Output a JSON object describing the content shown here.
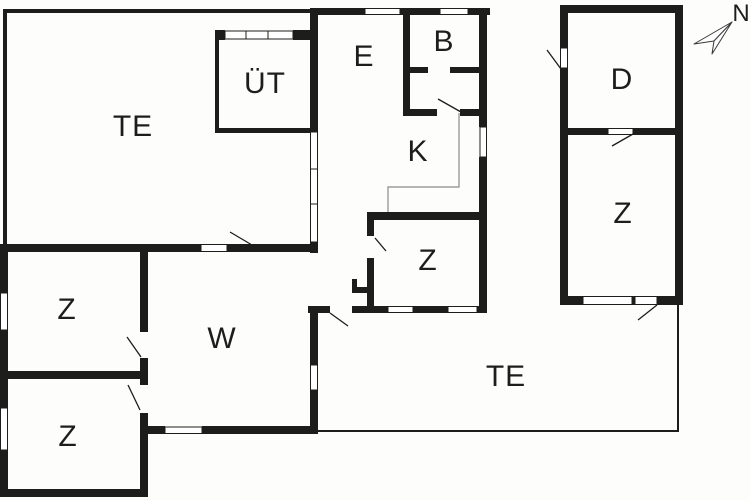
{
  "plan": {
    "title": "floor-plan",
    "compass": {
      "label": "N"
    },
    "rooms": {
      "te_top": "TE",
      "ut": "ÜT",
      "e": "E",
      "b": "B",
      "k": "K",
      "z_middle": "Z",
      "d": "D",
      "z_right": "Z",
      "z_upper_left": "Z",
      "z_lower_left": "Z",
      "w": "W",
      "te_bottom": "TE"
    },
    "colors": {
      "wall": "#1d1d1b",
      "background": "#fdfdfb",
      "window_fill": "#ffffff",
      "counter_line": "#8a8a8a"
    }
  }
}
